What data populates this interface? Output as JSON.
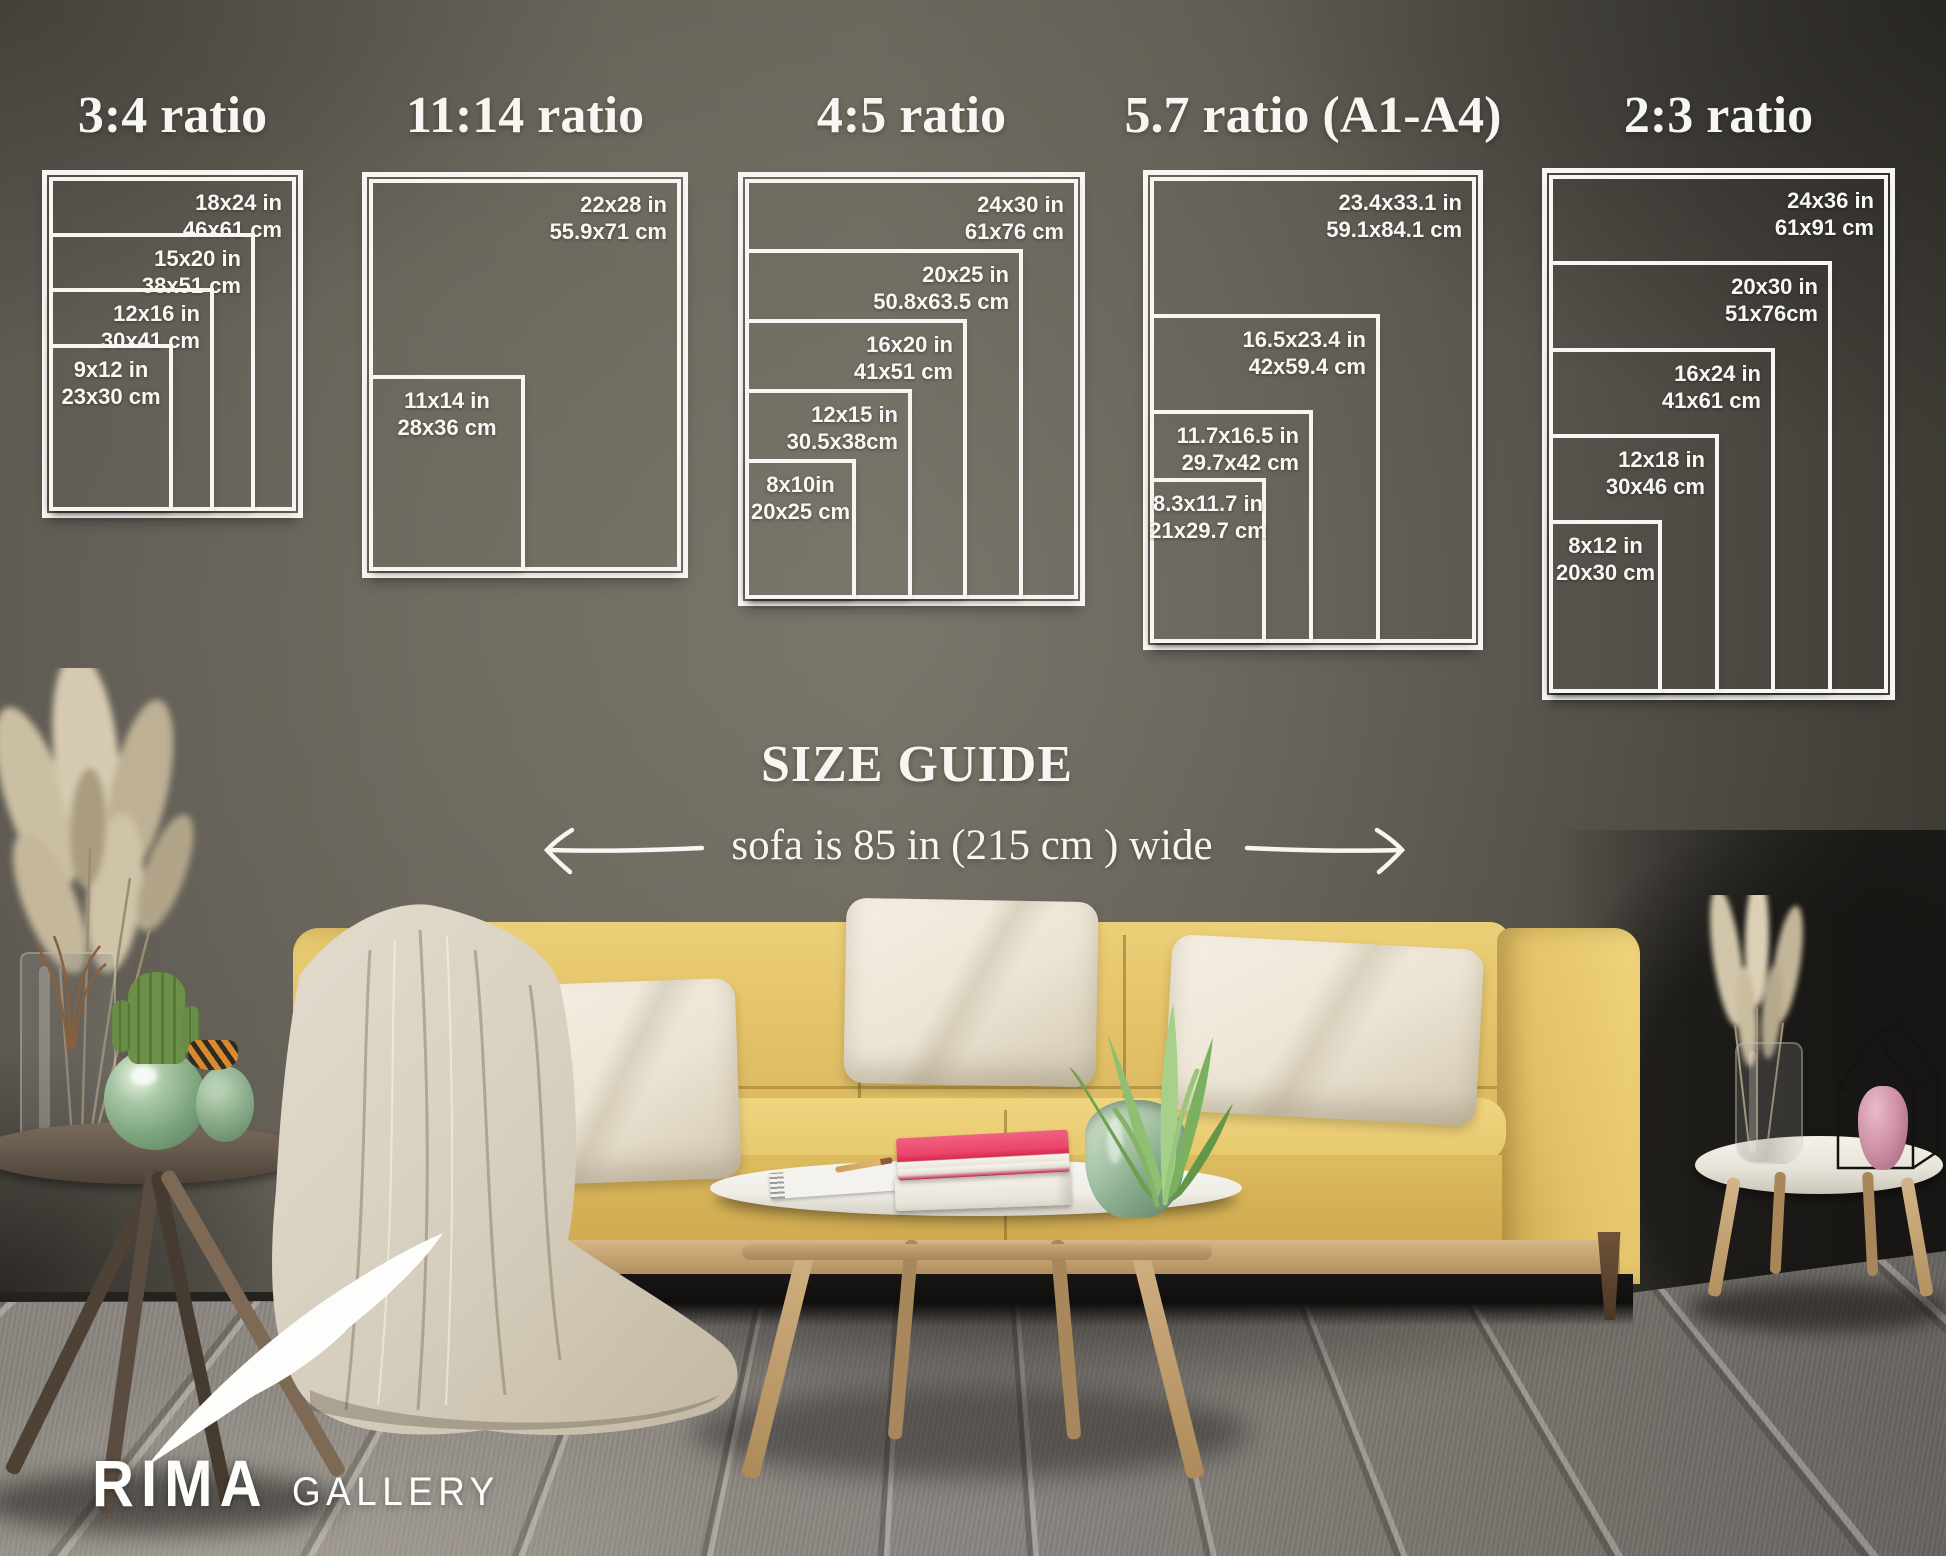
{
  "size_guide": {
    "heading": "SIZE GUIDE",
    "sofa_note": "sofa is 85 in (215 cm ) wide",
    "panels": [
      {
        "title": "3:4 ratio",
        "sizes": [
          {
            "inches": "18x24 in",
            "cm": "46x61 cm"
          },
          {
            "inches": "15x20 in",
            "cm": "38x51 cm"
          },
          {
            "inches": "12x16 in",
            "cm": "30x41 cm"
          },
          {
            "inches": "9x12 in",
            "cm": "23x30 cm"
          }
        ]
      },
      {
        "title": "11:14 ratio",
        "sizes": [
          {
            "inches": "22x28 in",
            "cm": "55.9x71 cm"
          },
          {
            "inches": "11x14 in",
            "cm": "28x36 cm"
          }
        ]
      },
      {
        "title": "4:5 ratio",
        "sizes": [
          {
            "inches": "24x30 in",
            "cm": "61x76 cm"
          },
          {
            "inches": "20x25 in",
            "cm": "50.8x63.5 cm"
          },
          {
            "inches": "16x20 in",
            "cm": "41x51 cm"
          },
          {
            "inches": "12x15 in",
            "cm": "30.5x38cm"
          },
          {
            "inches": "8x10in",
            "cm": "20x25 cm"
          }
        ]
      },
      {
        "title": "5.7 ratio (A1-A4)",
        "sizes": [
          {
            "inches": "23.4x33.1 in",
            "cm": "59.1x84.1 cm"
          },
          {
            "inches": "16.5x23.4 in",
            "cm": "42x59.4 cm"
          },
          {
            "inches": "11.7x16.5 in",
            "cm": "29.7x42 cm"
          },
          {
            "inches": "8.3x11.7 in",
            "cm": "21x29.7 cm"
          }
        ]
      },
      {
        "title": "2:3 ratio",
        "sizes": [
          {
            "inches": "24x36 in",
            "cm": "61x91 cm"
          },
          {
            "inches": "20x30 in",
            "cm": "51x76cm"
          },
          {
            "inches": "16x24 in",
            "cm": "41x61 cm"
          },
          {
            "inches": "12x18 in",
            "cm": "30x46 cm"
          },
          {
            "inches": "8x12 in",
            "cm": "20x30 cm"
          }
        ]
      }
    ]
  },
  "logo": {
    "brand": "RIMA",
    "suffix": "GALLERY"
  },
  "colors": {
    "overlay_white": "#f7f6f2",
    "wall_gray": "#635f57",
    "sofa_yellow": "#e3c365",
    "pillow_cream": "#ece5d6",
    "blanket_beige": "#d9d2c3",
    "book_pink": "#e94a66",
    "plant_green": "#7cab5e",
    "floor_gray": "#8a857e"
  }
}
